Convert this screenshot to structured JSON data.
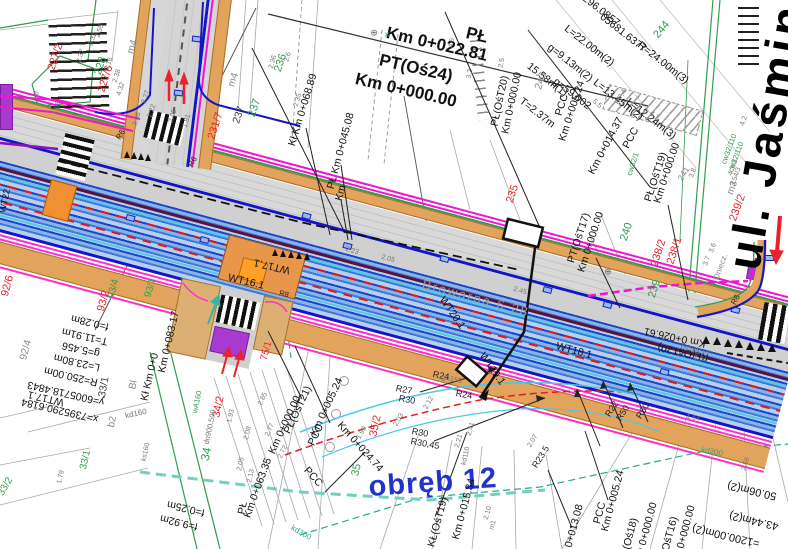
{
  "drawing": {
    "type": "road-design-cadastral-plan",
    "district_label": "obręb 12",
    "street_main": "ul. Jaśmin",
    "street_side": "Browarna 6 28"
  },
  "palette": {
    "road_band_blue": "#1a46c8",
    "edge_blue": "#1515c8",
    "sidewalk_orange": "#e2a35c",
    "island_orange": "#ffa126",
    "utility_magenta": "#f015d0",
    "boundary_pink": "#ff30c8",
    "box_purple": "#a93ad0",
    "axis_maroon": "#5a1238",
    "parcel_green": "#2f9e4f",
    "sewer_teal": "#2aa890",
    "arrow_red": "#e8232a",
    "district_blue": "#2233cc"
  },
  "labels": {
    "texts": [
      {
        "t": "ul. Jaśmin",
        "x": 766,
        "y": 136,
        "r": -80,
        "s": 47,
        "w": 700,
        "ls": 4,
        "c": "#000000"
      },
      {
        "t": "obręb 12",
        "x": 433,
        "y": 483,
        "r": -4,
        "s": 29,
        "w": 600,
        "ls": 1,
        "c": "#2233cc"
      },
      {
        "t": "Browarna 6 28",
        "x": 476,
        "y": 298,
        "r": 15,
        "s": 13,
        "ls": 2,
        "c": "#9a9a9a"
      }
    ],
    "kmBig": [
      {
        "t": "Km 0+022.81",
        "x": 437,
        "y": 44,
        "r": 13
      },
      {
        "t": "PŁ",
        "x": 477,
        "y": 35,
        "r": 13
      },
      {
        "t": "PT(Oś24)",
        "x": 416,
        "y": 68,
        "r": 13
      },
      {
        "t": "Km 0+000.00",
        "x": 406,
        "y": 90,
        "r": 13
      }
    ],
    "stations": [
      {
        "t": "Kł Km 0+068.89",
        "x": 303,
        "y": 110,
        "r": -73
      },
      {
        "t": "PŁ Km 0+045.08",
        "x": 341,
        "y": 151,
        "r": -75
      },
      {
        "t": "PŁ(OśT20)",
        "x": 500,
        "y": 101,
        "r": -78
      },
      {
        "t": "Km 0+000.00",
        "x": 512,
        "y": 103,
        "r": -78
      },
      {
        "t": "PCC",
        "x": 562,
        "y": 105,
        "r": -72
      },
      {
        "t": "Km 0+005.24",
        "x": 572,
        "y": 111,
        "r": -72
      },
      {
        "t": "PCC",
        "x": 631,
        "y": 138,
        "r": -62
      },
      {
        "t": "Km 0+014.37",
        "x": 606,
        "y": 146,
        "r": -62
      },
      {
        "t": "PŁ(OśT19)",
        "x": 656,
        "y": 177,
        "r": -72
      },
      {
        "t": "Km 0+000.00",
        "x": 667,
        "y": 173,
        "r": -72
      },
      {
        "t": "PT(OśT17)",
        "x": 579,
        "y": 238,
        "r": -72
      },
      {
        "t": "Km 0+000.00",
        "x": 591,
        "y": 242,
        "r": -72
      },
      {
        "t": "KŁ(OśT20)",
        "x": 683,
        "y": 352,
        "r": 192
      },
      {
        "t": "Km 0+026.61",
        "x": 675,
        "y": 337,
        "r": 192
      },
      {
        "t": "PŁ(OśT21)",
        "x": 298,
        "y": 410,
        "r": -65
      },
      {
        "t": "Km 0+000.00",
        "x": 285,
        "y": 425,
        "r": -65
      },
      {
        "t": "PCC",
        "x": 316,
        "y": 435,
        "r": -65
      },
      {
        "t": "Km 0+005.24",
        "x": 327,
        "y": 407,
        "r": -65
      },
      {
        "t": "PCC",
        "x": 313,
        "y": 477,
        "r": 48
      },
      {
        "t": "Km 0+024.74",
        "x": 360,
        "y": 447,
        "r": 48
      },
      {
        "t": "PŁ",
        "x": 243,
        "y": 508,
        "r": -78
      },
      {
        "t": "Km 0+063.35",
        "x": 258,
        "y": 488,
        "r": -70
      },
      {
        "t": "KŁ(OśT19)",
        "x": 438,
        "y": 522,
        "r": -75
      },
      {
        "t": "Km 0+015.34",
        "x": 464,
        "y": 509,
        "r": -75
      },
      {
        "t": "PCC",
        "x": 600,
        "y": 513,
        "r": -75
      },
      {
        "t": "Km 0+005.24",
        "x": 613,
        "y": 501,
        "r": -75
      },
      {
        "t": "PŁ(Oś18)",
        "x": 629,
        "y": 540,
        "r": -75
      },
      {
        "t": "Km 0+000.00",
        "x": 646,
        "y": 533,
        "r": -75
      },
      {
        "t": "PT(OśT16)",
        "x": 668,
        "y": 542,
        "r": -75
      },
      {
        "t": "Km 0+000.00",
        "x": 684,
        "y": 536,
        "r": -75
      },
      {
        "t": "Km 0+013.08",
        "x": 572,
        "y": 535,
        "r": -75
      },
      {
        "t": "Km 0+083.17",
        "x": 169,
        "y": 342,
        "r": -77
      },
      {
        "t": "Kł Km 0+0",
        "x": 150,
        "y": 377,
        "r": -77
      },
      {
        "t": "WT22",
        "x": 5,
        "y": 201,
        "r": -78,
        "s": 9
      },
      {
        "t": "Km",
        "x": 341,
        "y": 193,
        "r": -75
      }
    ],
    "geomBlock": [
      {
        "t": "296.0857",
        "x": 601,
        "y": 11
      },
      {
        "t": "05681.6377",
        "x": 623,
        "y": 33
      },
      {
        "t": "L=22.00m(2)",
        "x": 589,
        "y": 46
      },
      {
        "t": "R=24.00m(3)",
        "x": 663,
        "y": 63
      },
      {
        "t": "g=9.13m(2)",
        "x": 570,
        "y": 63
      },
      {
        "t": "15.58m(1)",
        "x": 547,
        "y": 80
      },
      {
        "t": "g=59.002",
        "x": 572,
        "y": 94
      },
      {
        "t": "L=13.45m(2)",
        "x": 618,
        "y": 100
      },
      {
        "t": "L=12.24m(3)",
        "x": 651,
        "y": 119
      },
      {
        "t": "T=2.37m",
        "x": 537,
        "y": 113
      }
    ],
    "coordBlockLeft": [
      {
        "t": "f=0.28m",
        "x": 90,
        "y": 322
      },
      {
        "t": "T=11.91m",
        "x": 85,
        "y": 336
      },
      {
        "t": "g=5.456",
        "x": 81,
        "y": 349
      },
      {
        "t": "L=23.80m",
        "x": 77,
        "y": 362
      },
      {
        "t": "R=250.00m",
        "x": 71,
        "y": 376
      },
      {
        "t": "y=6005718.4843",
        "x": 66,
        "y": 393
      },
      {
        "t": "x=7395290.6184",
        "x": 60,
        "y": 410
      },
      {
        "t": "WT17.1",
        "x": 46,
        "y": 398
      },
      {
        "t": "f=0.25m",
        "x": 186,
        "y": 508
      },
      {
        "t": "f=9.92m",
        "x": 179,
        "y": 522
      }
    ],
    "measureBlockRight": [
      {
        "t": "=1200.00m(2)",
        "x": 726,
        "y": 535
      },
      {
        "t": "43.44m(2)",
        "x": 754,
        "y": 520
      },
      {
        "t": "50.06m(2)",
        "x": 752,
        "y": 490
      }
    ],
    "parcelsRed": [
      {
        "t": "227/2",
        "x": 56,
        "y": 57,
        "r": -72
      },
      {
        "t": "227/6",
        "x": 106,
        "y": 79,
        "r": -72
      },
      {
        "t": "231/7",
        "x": 216,
        "y": 126,
        "r": -72
      },
      {
        "t": "235",
        "x": 513,
        "y": 194,
        "r": -72
      },
      {
        "t": "238/1",
        "x": 675,
        "y": 251,
        "r": -72
      },
      {
        "t": "238/2",
        "x": 659,
        "y": 253,
        "r": -72
      },
      {
        "t": "239/2",
        "x": 738,
        "y": 208,
        "r": -70
      },
      {
        "t": "93/2",
        "x": 104,
        "y": 301,
        "r": -75
      },
      {
        "t": "92/6",
        "x": 8,
        "y": 286,
        "r": -75
      },
      {
        "t": "34/2",
        "x": 219,
        "y": 407,
        "r": -78
      },
      {
        "t": "35/2",
        "x": 376,
        "y": 426,
        "r": -78
      },
      {
        "t": "75/1",
        "x": 267,
        "y": 351,
        "r": -75,
        "s": 10
      }
    ],
    "parcelsGreen": [
      {
        "t": "228",
        "x": 101,
        "y": 66,
        "r": -72
      },
      {
        "t": "236",
        "x": 281,
        "y": 63,
        "r": -72
      },
      {
        "t": "237",
        "x": 255,
        "y": 108,
        "r": -72
      },
      {
        "t": "244",
        "x": 662,
        "y": 30,
        "r": -50
      },
      {
        "t": "240",
        "x": 627,
        "y": 232,
        "r": -72
      },
      {
        "t": "239",
        "x": 655,
        "y": 289,
        "r": -72
      },
      {
        "t": "34",
        "x": 206,
        "y": 454,
        "r": -78,
        "s": 12
      },
      {
        "t": "35",
        "x": 357,
        "y": 470,
        "r": -78
      },
      {
        "t": "33/1",
        "x": 86,
        "y": 460,
        "r": -78,
        "s": 10
      },
      {
        "t": "33/2",
        "x": 6,
        "y": 487,
        "r": -60,
        "s": 10
      },
      {
        "t": "93/4",
        "x": 114,
        "y": 289,
        "r": -75,
        "s": 10
      },
      {
        "t": "93/1",
        "x": 151,
        "y": 288,
        "r": -75,
        "s": 10
      }
    ],
    "parcelsGray": [
      {
        "t": "237",
        "x": 239,
        "y": 115,
        "r": -72,
        "c": "#444"
      },
      {
        "t": "243",
        "x": 541,
        "y": 81,
        "r": -72
      },
      {
        "t": "m4",
        "x": 133,
        "y": 47,
        "r": -72,
        "s": 10
      },
      {
        "t": "m4",
        "x": 234,
        "y": 80,
        "r": -72,
        "s": 10
      },
      {
        "t": "m3",
        "x": 733,
        "y": 188,
        "r": -70,
        "s": 10
      },
      {
        "t": "b2",
        "x": 113,
        "y": 422,
        "r": -78,
        "s": 10
      },
      {
        "t": "Bl",
        "x": 134,
        "y": 385,
        "r": -78,
        "s": 10
      },
      {
        "t": "92/4",
        "x": 26,
        "y": 350,
        "r": -75
      },
      {
        "t": "33/1",
        "x": 104,
        "y": 387,
        "r": -80,
        "c": "#444"
      },
      {
        "t": "241",
        "x": 684,
        "y": 174,
        "r": -60,
        "s": 9
      },
      {
        "t": "BP.4",
        "x": 621,
        "y": 97,
        "r": -60,
        "s": 8
      },
      {
        "t": "Oniecz.",
        "x": 721,
        "y": 267,
        "r": -70,
        "s": 8
      }
    ],
    "wt": [
      {
        "t": "WT20.1",
        "x": 452,
        "y": 313,
        "r": 55
      },
      {
        "t": "WT19.1",
        "x": 492,
        "y": 369,
        "r": 55
      },
      {
        "t": "WT18.1",
        "x": 574,
        "y": 351,
        "r": 15
      },
      {
        "t": "WT17.1",
        "x": 272,
        "y": 266,
        "r": 193
      },
      {
        "t": "WT16.1",
        "x": 246,
        "y": 282,
        "r": 13
      }
    ],
    "radii": [
      {
        "t": "R27",
        "x": 404,
        "y": 390,
        "r": 10
      },
      {
        "t": "R30",
        "x": 407,
        "y": 400,
        "r": 10
      },
      {
        "t": "R30",
        "x": 420,
        "y": 433,
        "r": 10
      },
      {
        "t": "R30,45",
        "x": 425,
        "y": 444,
        "r": 10
      },
      {
        "t": "R22",
        "x": 612,
        "y": 409,
        "r": -58
      },
      {
        "t": "R50",
        "x": 623,
        "y": 413,
        "r": -58
      },
      {
        "t": "R50",
        "x": 643,
        "y": 411,
        "r": -58
      },
      {
        "t": "R23.5",
        "x": 541,
        "y": 457,
        "r": -58
      },
      {
        "t": "R24",
        "x": 441,
        "y": 376,
        "r": 10
      },
      {
        "t": "R24",
        "x": 464,
        "y": 395,
        "r": 10
      },
      {
        "t": "R6",
        "x": 121,
        "y": 135,
        "r": -60,
        "s": 8
      },
      {
        "t": "R6",
        "x": 193,
        "y": 162,
        "r": -60,
        "s": 8
      },
      {
        "t": "R6",
        "x": 736,
        "y": 300,
        "r": -60,
        "s": 8
      },
      {
        "t": "R8",
        "x": 284,
        "y": 294,
        "r": 13,
        "s": 7.5
      }
    ],
    "utilities": [
      {
        "t": "kd160",
        "x": 136,
        "y": 414,
        "r": -12
      },
      {
        "t": "kd300",
        "x": 301,
        "y": 533,
        "r": 30,
        "c": "#2aa890"
      },
      {
        "t": "kd200",
        "x": 712,
        "y": 452,
        "r": 12,
        "c": "#2aa890"
      },
      {
        "t": "kd110",
        "x": 466,
        "y": 456,
        "r": -78,
        "s": 7
      },
      {
        "t": "ks160",
        "x": 146,
        "y": 452,
        "r": -78,
        "s": 7
      },
      {
        "t": "wA160",
        "x": 197,
        "y": 402,
        "r": -78,
        "s": 7.5,
        "c": "#2f9e4f"
      },
      {
        "t": "dn900.500",
        "x": 210,
        "y": 427,
        "r": -78,
        "s": 7.5
      },
      {
        "t": "gn150",
        "x": 452,
        "y": 379,
        "r": 12,
        "s": 7.5
      },
      {
        "t": "cw32/110",
        "x": 729,
        "y": 149,
        "r": -70,
        "s": 7.5,
        "c": "#2f9e4f"
      },
      {
        "t": "cw32/110",
        "x": 736,
        "y": 157,
        "r": -70,
        "s": 7.5,
        "c": "#2f9e4f"
      },
      {
        "t": "cw32/1",
        "x": 633,
        "y": 164,
        "r": -72,
        "s": 7.5,
        "c": "#2f9e4f"
      },
      {
        "t": "w100/150",
        "x": 696,
        "y": 349,
        "r": 192,
        "s": 7
      }
    ],
    "dims": [
      {
        "t": "2.35",
        "x": 298,
        "y": 100,
        "r": -75
      },
      {
        "t": "2.6",
        "x": 288,
        "y": 57,
        "r": -75
      },
      {
        "t": "2.36",
        "x": 273,
        "y": 62,
        "r": -75
      },
      {
        "t": "2.16",
        "x": 109,
        "y": 64,
        "r": -72
      },
      {
        "t": "2.32",
        "x": 93,
        "y": 39,
        "r": -72
      },
      {
        "t": "2.55",
        "x": 100,
        "y": 31,
        "r": -72
      },
      {
        "t": "2.38",
        "x": 117,
        "y": 76,
        "r": -72
      },
      {
        "t": "4.32",
        "x": 121,
        "y": 89,
        "r": -72
      },
      {
        "t": "2.37",
        "x": 81,
        "y": 56,
        "r": -72
      },
      {
        "t": "3.2",
        "x": 470,
        "y": 74,
        "r": -80
      },
      {
        "t": "4.6",
        "x": 452,
        "y": 43,
        "r": -80
      },
      {
        "t": "2.5",
        "x": 502,
        "y": 63,
        "r": -80
      },
      {
        "t": "1.68",
        "x": 57,
        "y": 108,
        "r": -75
      },
      {
        "t": "1.8",
        "x": 36,
        "y": 96,
        "r": -75
      },
      {
        "t": "5.5",
        "x": 597,
        "y": 104,
        "r": 40
      },
      {
        "t": "4.7",
        "x": 654,
        "y": 116,
        "r": 40
      },
      {
        "t": "2.27",
        "x": 146,
        "y": 97,
        "r": -72
      },
      {
        "t": "2.22",
        "x": 152,
        "y": 111,
        "r": -72
      },
      {
        "t": "2.08",
        "x": 137,
        "y": 119,
        "r": -72
      },
      {
        "t": "2.05",
        "x": 173,
        "y": 116,
        "r": -72
      },
      {
        "t": "1.81",
        "x": 187,
        "y": 121,
        "r": -72
      },
      {
        "t": "2.03",
        "x": 399,
        "y": 420,
        "r": -60
      },
      {
        "t": "2.12",
        "x": 429,
        "y": 403,
        "r": -60
      },
      {
        "t": "1.99",
        "x": 362,
        "y": 433,
        "r": -60
      },
      {
        "t": "2.41",
        "x": 471,
        "y": 429,
        "r": -75
      },
      {
        "t": "2.21",
        "x": 459,
        "y": 441,
        "r": -75
      },
      {
        "t": "2.10",
        "x": 488,
        "y": 513,
        "r": -75
      },
      {
        "t": "m1",
        "x": 493,
        "y": 525,
        "r": -75
      },
      {
        "t": "2.59",
        "x": 746,
        "y": 464,
        "r": -75
      },
      {
        "t": "1.64",
        "x": 693,
        "y": 418,
        "r": 13
      },
      {
        "t": "2.07",
        "x": 533,
        "y": 441,
        "r": -60
      },
      {
        "t": "1.79",
        "x": 61,
        "y": 477,
        "r": -78
      },
      {
        "t": "2.13",
        "x": 251,
        "y": 476,
        "r": -78
      },
      {
        "t": "2.05",
        "x": 241,
        "y": 464,
        "r": -78
      },
      {
        "t": "1.93",
        "x": 231,
        "y": 416,
        "r": -78
      },
      {
        "t": "2.08",
        "x": 248,
        "y": 433,
        "r": -78
      },
      {
        "t": "3.6",
        "x": 713,
        "y": 248,
        "r": -70
      },
      {
        "t": "3.7",
        "x": 707,
        "y": 261,
        "r": -70
      },
      {
        "t": "4.2",
        "x": 744,
        "y": 121,
        "r": -70
      },
      {
        "t": "3.8",
        "x": 693,
        "y": 173,
        "r": -70
      },
      {
        "t": "3.54/3",
        "x": 736,
        "y": 177,
        "r": -70
      },
      {
        "t": "4.3/3",
        "x": 733,
        "y": 168,
        "r": -70
      },
      {
        "t": "2.77",
        "x": 270,
        "y": 430,
        "r": -65
      },
      {
        "t": "2.72",
        "x": 283,
        "y": 452,
        "r": -65
      },
      {
        "t": "2.85",
        "x": 263,
        "y": 399,
        "r": -65
      },
      {
        "t": "2.64",
        "x": 700,
        "y": 359,
        "r": 12
      },
      {
        "t": "2.23",
        "x": 352,
        "y": 251,
        "r": 15
      },
      {
        "t": "2.05",
        "x": 388,
        "y": 259,
        "r": 15
      },
      {
        "t": "2.45",
        "x": 520,
        "y": 291,
        "r": 15
      },
      {
        "t": "⊕",
        "x": 374,
        "y": 33,
        "s": 9,
        "c": "#666"
      },
      {
        "t": "⊕",
        "x": 608,
        "y": 272,
        "s": 9,
        "c": "#666"
      },
      {
        "t": "×",
        "x": 387,
        "y": 36,
        "s": 10,
        "c": "#2f9e4f"
      }
    ]
  }
}
